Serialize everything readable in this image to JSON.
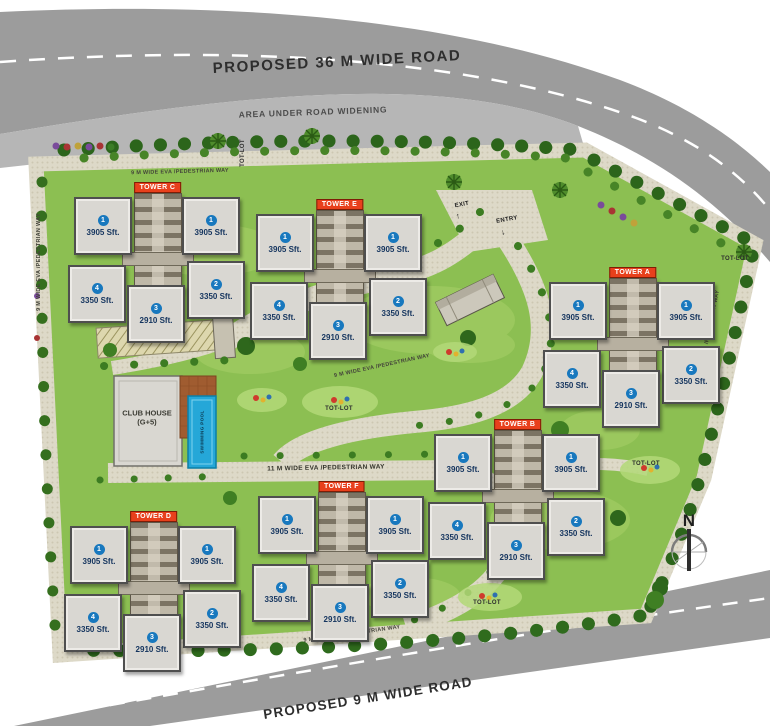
{
  "roads": {
    "top_label": "PROPOSED 36 M WIDE ROAD",
    "widening_label": "AREA UNDER ROAD WIDENING",
    "bottom_label": "PROPOSED 9 M WIDE ROAD"
  },
  "paths": {
    "eva_9m": "9 M WIDE EVA /PEDESTRIAN WAY",
    "eva_11m": "11 M WIDE EVA /PEDESTRIAN WAY"
  },
  "gate": {
    "entry_label": "ENTRY",
    "exit_label": "EXIT",
    "entry_arrow": "↓",
    "exit_arrow": "↑"
  },
  "amenities": {
    "clubhouse_line1": "CLUB HOUSE",
    "clubhouse_line2": "(G+5)",
    "pool_label": "SWIMMING POOL",
    "totlot_label": "TOT-LOT"
  },
  "compass": {
    "north_label": "N"
  },
  "colors": {
    "road": "#9c9c9c",
    "widening": "#b6b6b6",
    "lawn": "#8cbf52",
    "paving": "#ddd9c8",
    "tree": "#2c651b",
    "tower_label_bg": "#e8401c",
    "unit_badge": "#1878be",
    "pool": "#25a7d8"
  },
  "towers": [
    {
      "name": "TOWER C",
      "units": [
        {
          "num": "1",
          "size": "3905 Sft."
        },
        {
          "num": "1",
          "size": "3905 Sft."
        },
        {
          "num": "4",
          "size": "3350 Sft."
        },
        {
          "num": "2",
          "size": "3350 Sft."
        },
        {
          "num": "3",
          "size": "2910 Sft."
        }
      ]
    },
    {
      "name": "TOWER E",
      "units": [
        {
          "num": "1",
          "size": "3905 Sft."
        },
        {
          "num": "1",
          "size": "3905 Sft."
        },
        {
          "num": "4",
          "size": "3350 Sft."
        },
        {
          "num": "2",
          "size": "3350 Sft."
        },
        {
          "num": "3",
          "size": "2910 Sft."
        }
      ]
    },
    {
      "name": "TOWER A",
      "units": [
        {
          "num": "1",
          "size": "3905 Sft."
        },
        {
          "num": "1",
          "size": "3905 Sft."
        },
        {
          "num": "4",
          "size": "3350 Sft."
        },
        {
          "num": "2",
          "size": "3350 Sft."
        },
        {
          "num": "3",
          "size": "2910 Sft."
        }
      ]
    },
    {
      "name": "TOWER B",
      "units": [
        {
          "num": "1",
          "size": "3905 Sft."
        },
        {
          "num": "1",
          "size": "3905 Sft."
        },
        {
          "num": "4",
          "size": "3350 Sft."
        },
        {
          "num": "2",
          "size": "3350 Sft."
        },
        {
          "num": "3",
          "size": "2910 Sft."
        }
      ]
    },
    {
      "name": "TOWER D",
      "units": [
        {
          "num": "1",
          "size": "3905 Sft."
        },
        {
          "num": "1",
          "size": "3905 Sft."
        },
        {
          "num": "4",
          "size": "3350 Sft."
        },
        {
          "num": "2",
          "size": "3350 Sft."
        },
        {
          "num": "3",
          "size": "2910 Sft."
        }
      ]
    },
    {
      "name": "TOWER F",
      "units": [
        {
          "num": "1",
          "size": "3905 Sft."
        },
        {
          "num": "1",
          "size": "3905 Sft."
        },
        {
          "num": "4",
          "size": "3350 Sft."
        },
        {
          "num": "2",
          "size": "3350 Sft."
        },
        {
          "num": "3",
          "size": "2910 Sft."
        }
      ]
    }
  ]
}
